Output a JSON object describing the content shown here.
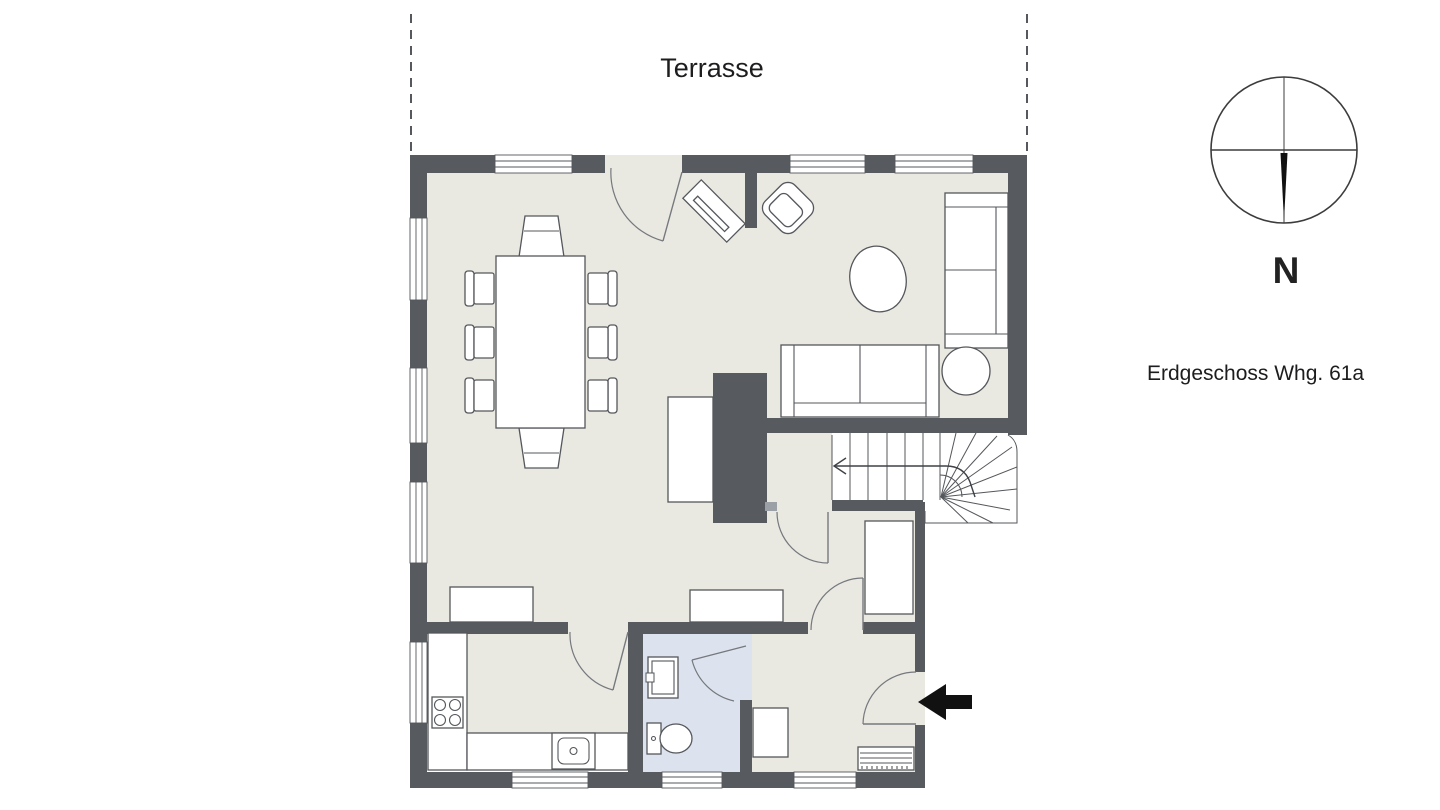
{
  "labels": {
    "terrace": "Terrasse",
    "north": "N",
    "plan_title": "Erdgeschoss Whg. 61a"
  },
  "colors": {
    "wall": "#575b60",
    "floor": "#e9e8e1",
    "bathroom_floor": "#dde3ee",
    "outline": "#54575b",
    "door_arc": "#75797d",
    "background": "#ffffff",
    "arrow": "#111111",
    "text": "#1d1d1f",
    "hinge_pad": "#9aa0a6",
    "dashed_line": "#55585c"
  },
  "icons": {
    "compass_rose": "compass-rose-icon",
    "entrance_arrow": "entrance-arrow-icon",
    "stair_direction_arrow": "stair-direction-arrow-icon"
  }
}
